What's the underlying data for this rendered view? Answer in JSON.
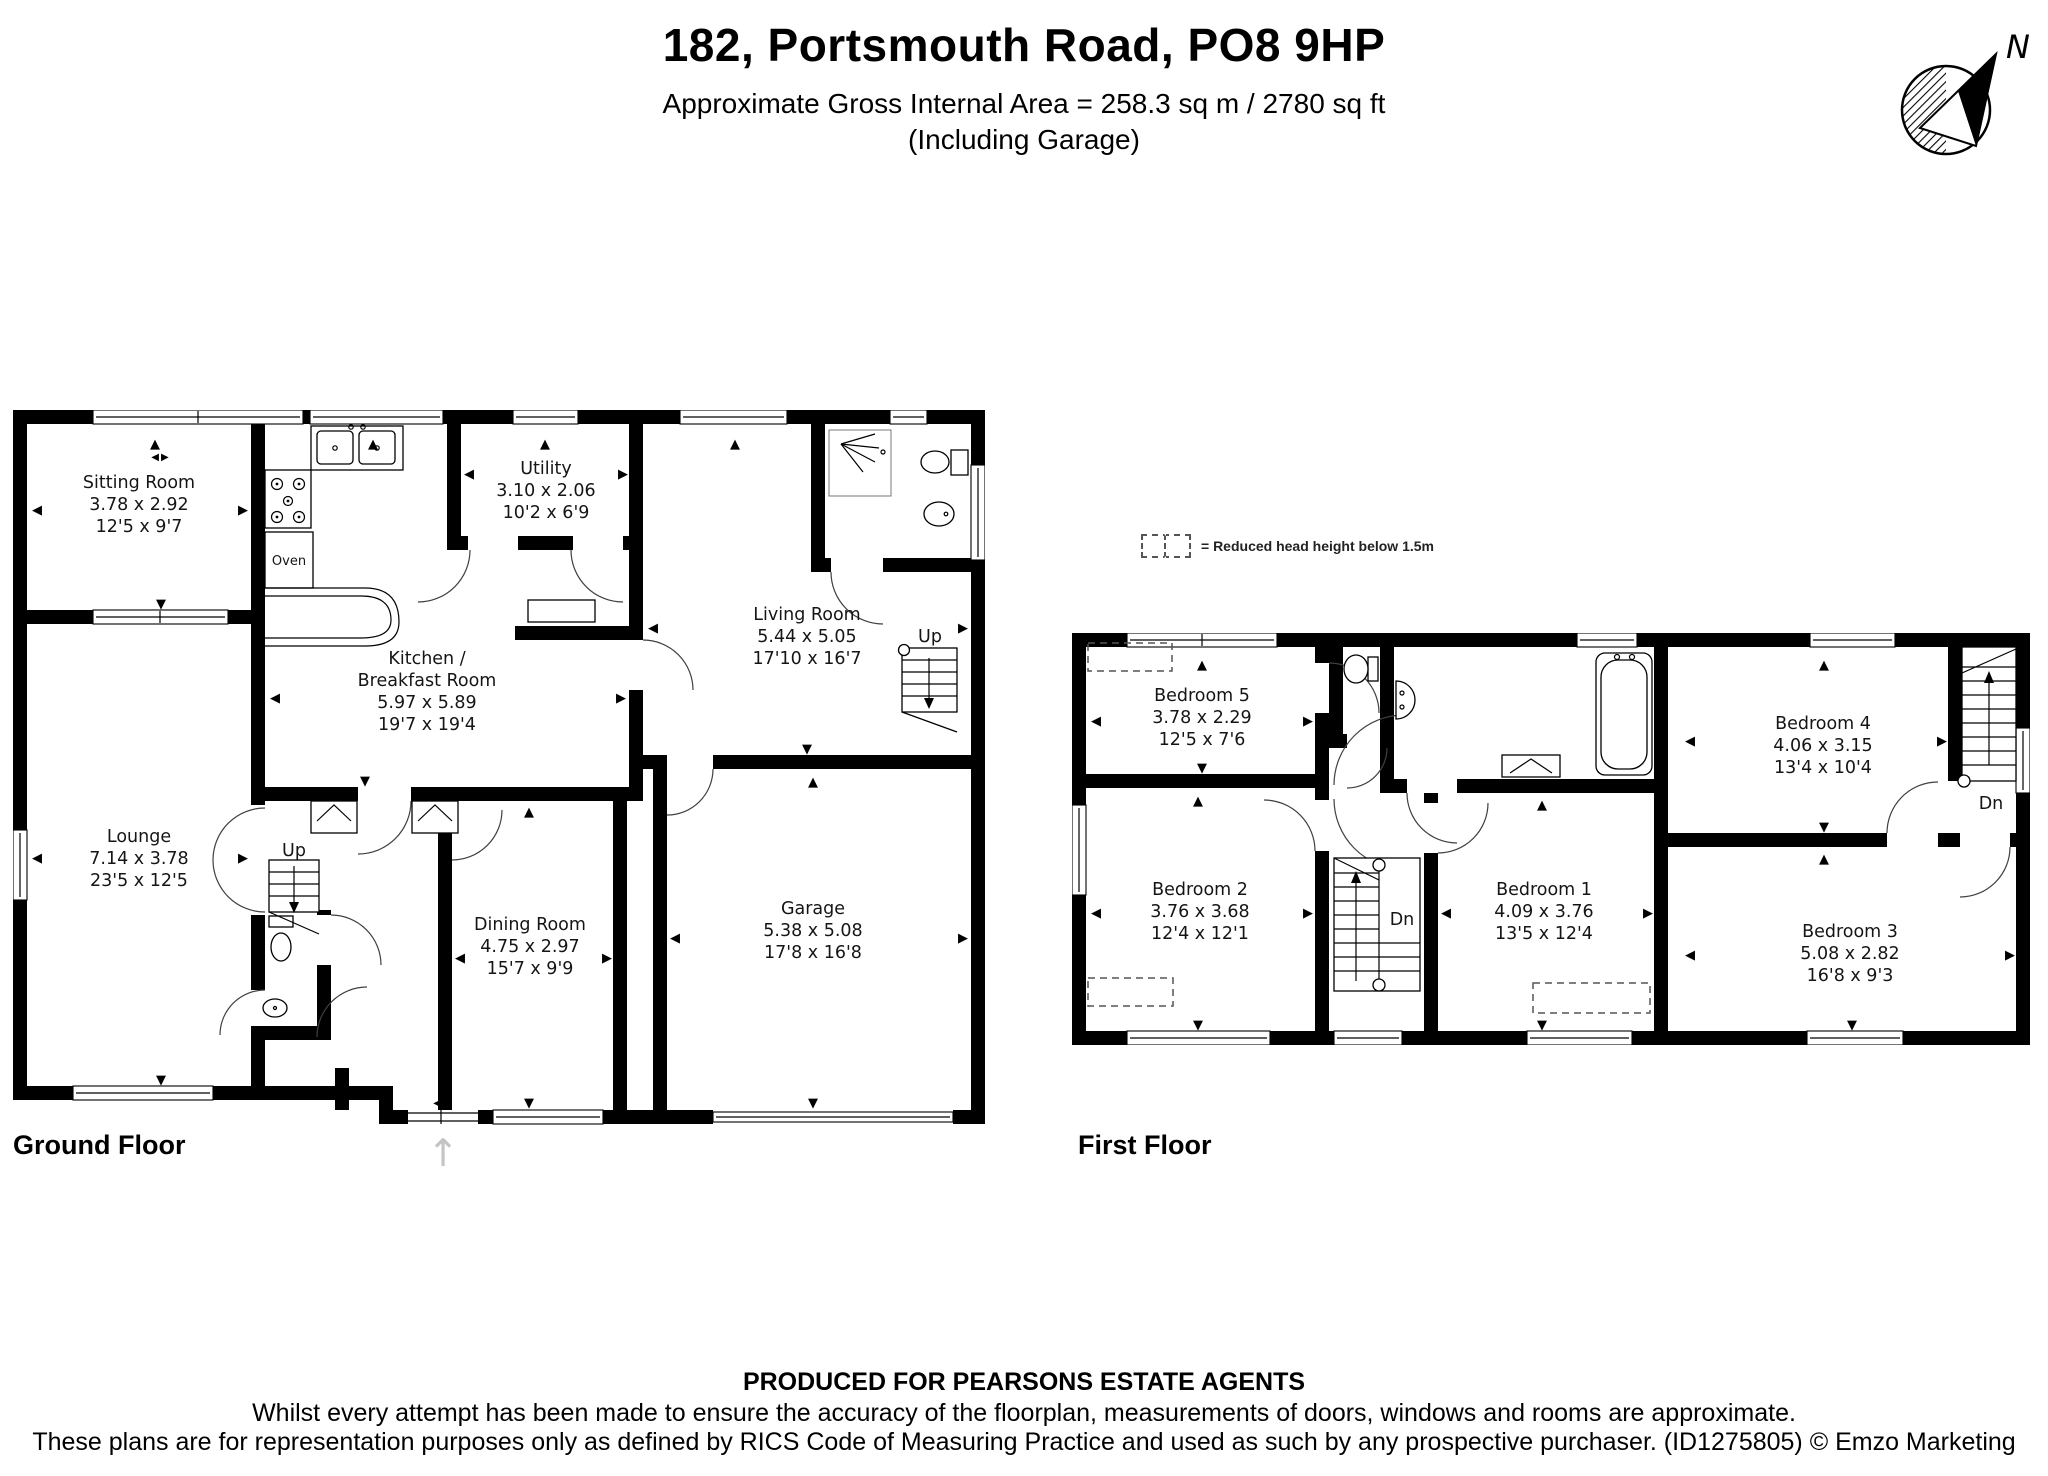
{
  "header": {
    "title": "182, Portsmouth Road, PO8 9HP",
    "subtitle": "Approximate Gross Internal Area = 258.3 sq m / 2780 sq ft",
    "subtitle2": "(Including Garage)"
  },
  "compass": {
    "north_label": "N"
  },
  "legend": {
    "text": "= Reduced head height below 1.5m"
  },
  "floors": {
    "ground": {
      "label": "Ground Floor",
      "rooms": {
        "sitting": {
          "name": "Sitting Room",
          "metric": "3.78 x 2.92",
          "imperial": "12'5 x 9'7"
        },
        "lounge": {
          "name": "Lounge",
          "metric": "7.14 x 3.78",
          "imperial": "23'5 x 12'5"
        },
        "kitchen": {
          "name1": "Kitchen /",
          "name2": "Breakfast Room",
          "metric": "5.97 x 5.89",
          "imperial": "19'7 x 19'4"
        },
        "utility": {
          "name": "Utility",
          "metric": "3.10 x 2.06",
          "imperial": "10'2 x 6'9"
        },
        "living": {
          "name": "Living Room",
          "metric": "5.44 x 5.05",
          "imperial": "17'10 x 16'7"
        },
        "dining": {
          "name": "Dining Room",
          "metric": "4.75 x 2.97",
          "imperial": "15'7 x 9'9"
        },
        "garage": {
          "name": "Garage",
          "metric": "5.38 x 5.08",
          "imperial": "17'8 x 16'8"
        },
        "oven_label": "Oven",
        "stairs_hall": "Up",
        "stairs_living": "Up"
      }
    },
    "first": {
      "label": "First Floor",
      "rooms": {
        "bed1": {
          "name": "Bedroom 1",
          "metric": "4.09 x 3.76",
          "imperial": "13'5 x 12'4"
        },
        "bed2": {
          "name": "Bedroom 2",
          "metric": "3.76 x 3.68",
          "imperial": "12'4 x 12'1"
        },
        "bed3": {
          "name": "Bedroom 3",
          "metric": "5.08 x 2.82",
          "imperial": "16'8 x 9'3"
        },
        "bed4": {
          "name": "Bedroom 4",
          "metric": "4.06 x 3.15",
          "imperial": "13'4 x 10'4"
        },
        "bed5": {
          "name": "Bedroom 5",
          "metric": "3.78 x 2.29",
          "imperial": "12'5 x 7'6"
        },
        "stairs_central": "Dn",
        "stairs_right": "Dn"
      }
    }
  },
  "footer": {
    "line1": "PRODUCED FOR PEARSONS ESTATE AGENTS",
    "line2": "Whilst every attempt has been made to ensure the accuracy of the floorplan, measurements of doors, windows and rooms are approximate.",
    "line3": "These plans are for representation purposes only as defined by RICS Code of Measuring Practice and used as such by any prospective purchaser. (ID1275805) © Emzo Marketing"
  }
}
